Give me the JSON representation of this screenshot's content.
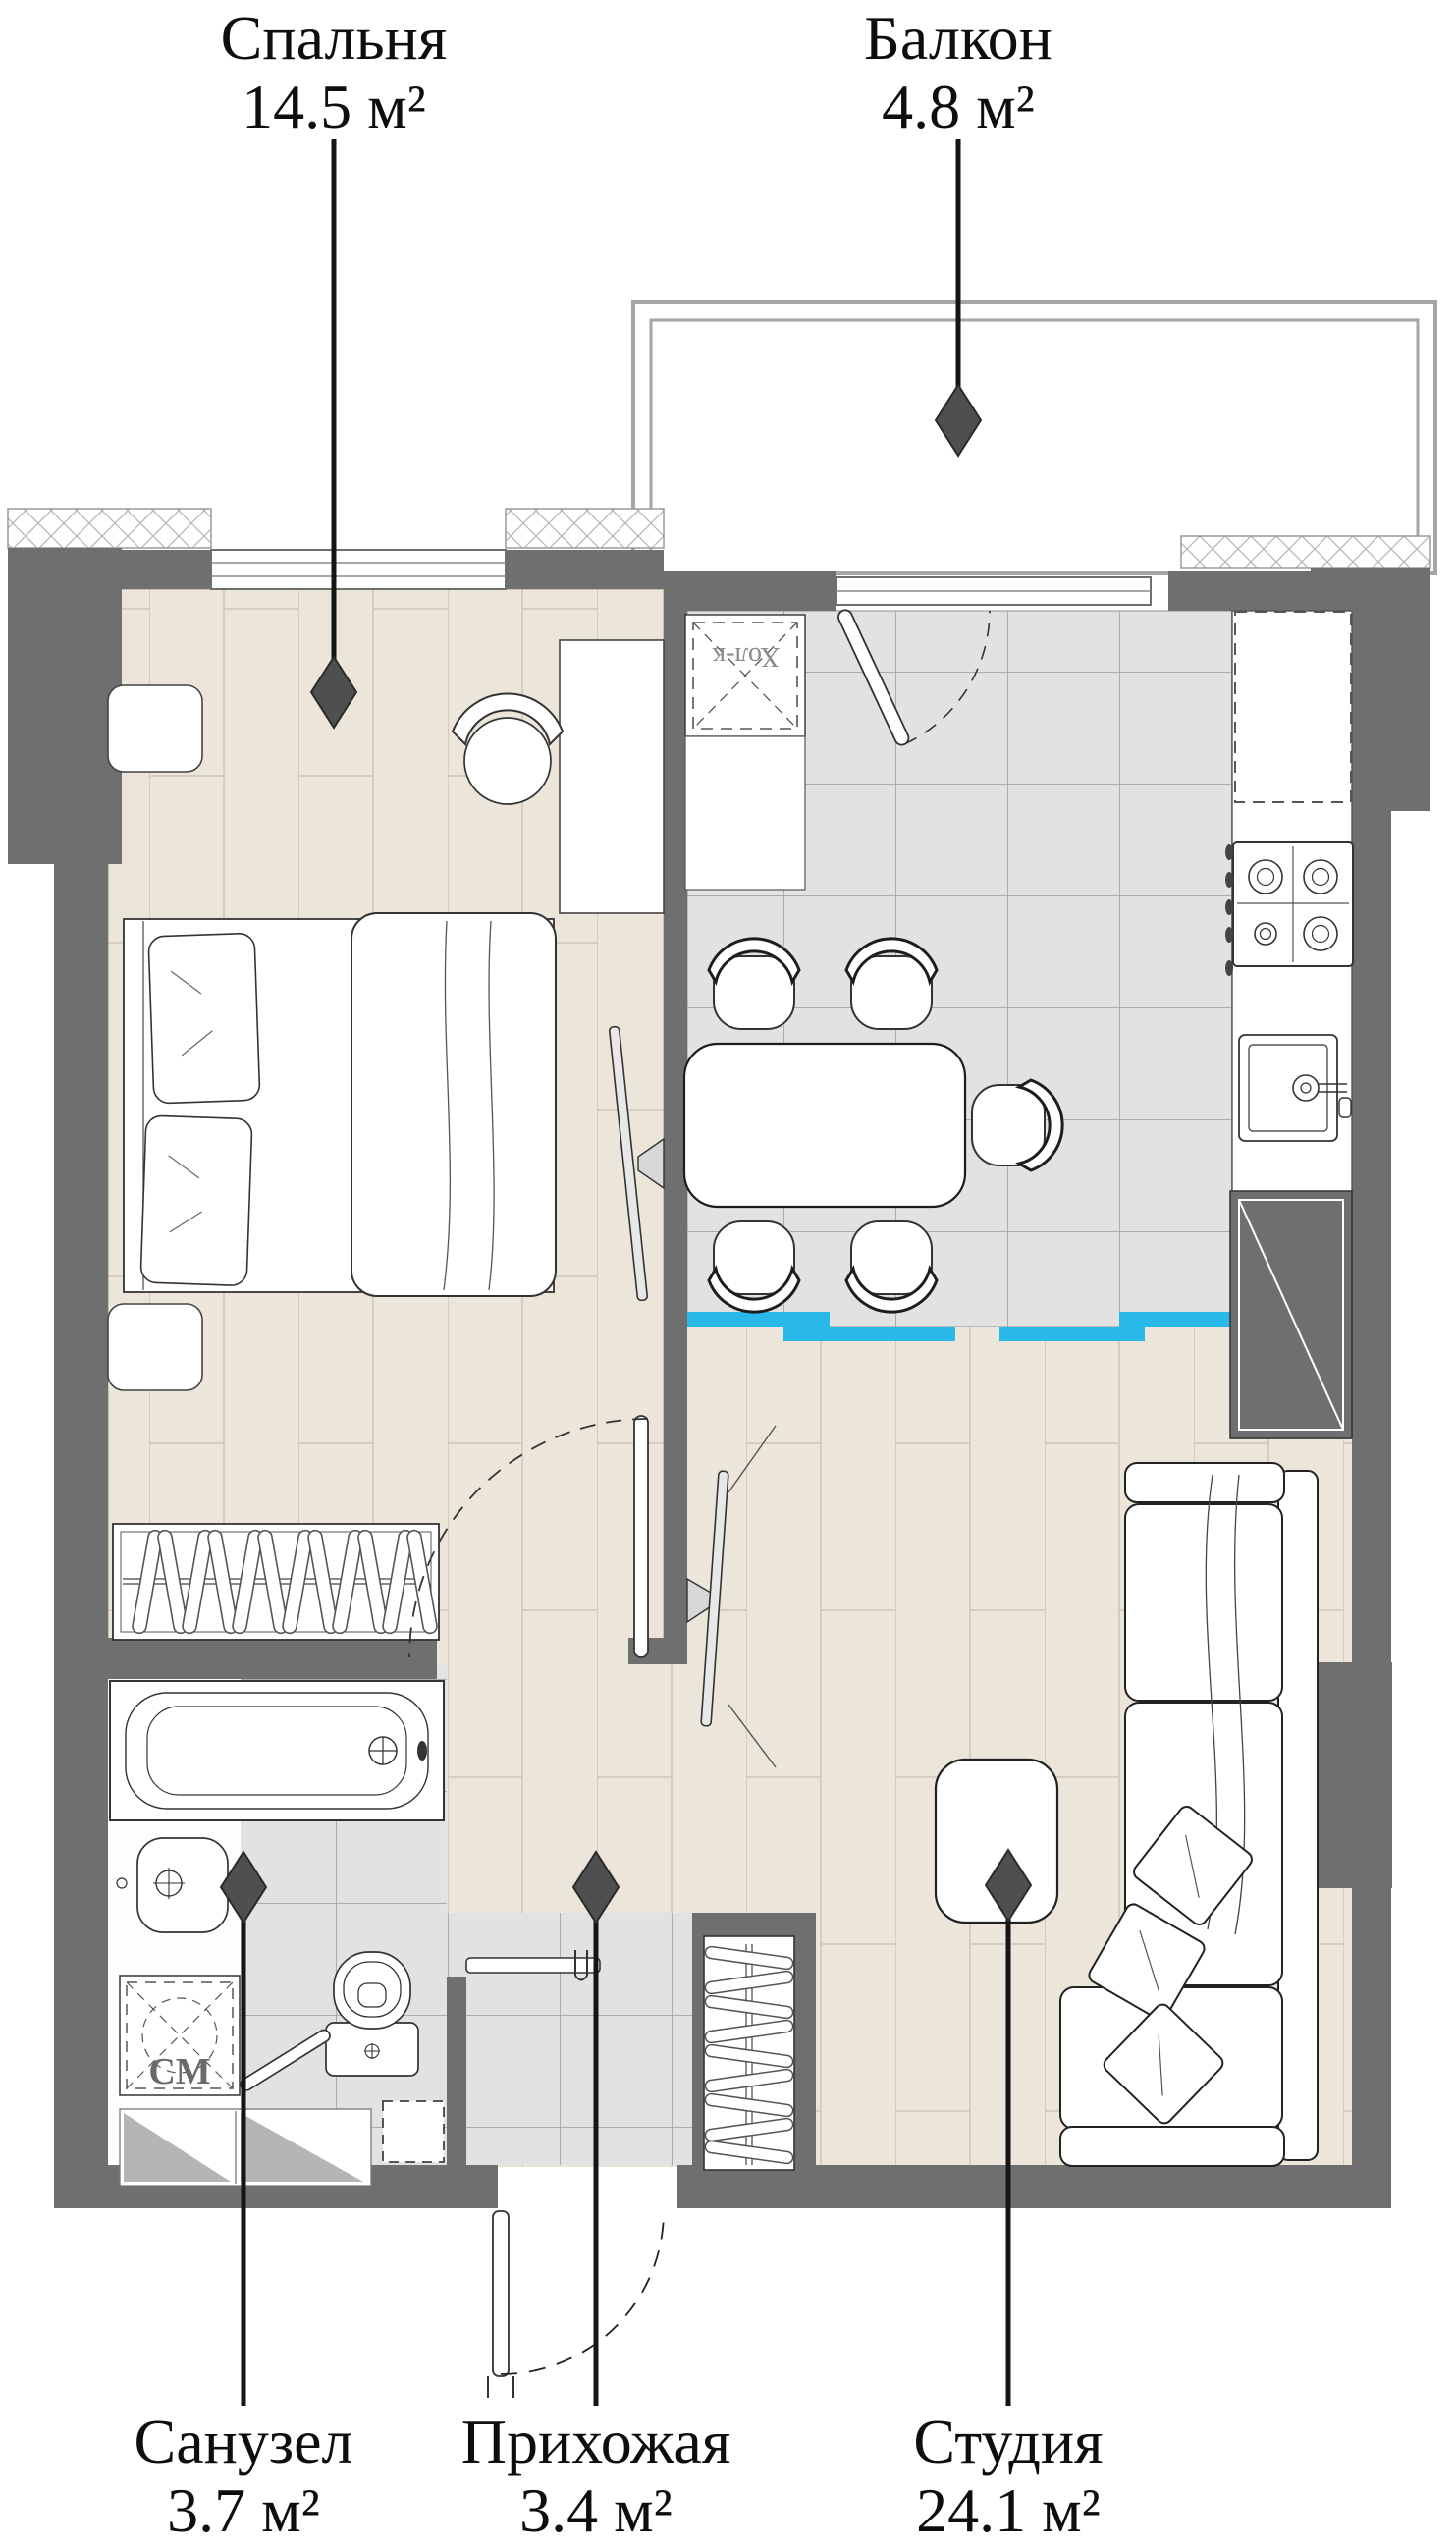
{
  "rooms": [
    {
      "id": "bedroom",
      "name": "Спальня",
      "area": "14.5 м²"
    },
    {
      "id": "balcony",
      "name": "Балкон",
      "area": "4.8 м²"
    },
    {
      "id": "bathroom",
      "name": "Санузел",
      "area": "3.7 м²"
    },
    {
      "id": "hallway",
      "name": "Прихожая",
      "area": "3.4 м²"
    },
    {
      "id": "studio",
      "name": "Студия",
      "area": "24.1 м²"
    }
  ],
  "appliances": {
    "fridge_label": "Хол-к",
    "washer_label": "СМ"
  },
  "colors": {
    "wall": "#6f6f6f",
    "wood_floor": "#ebe5da",
    "tile_floor": "#e2e2e2",
    "floor_divider": "#29b9e8",
    "leader": "#151515"
  }
}
